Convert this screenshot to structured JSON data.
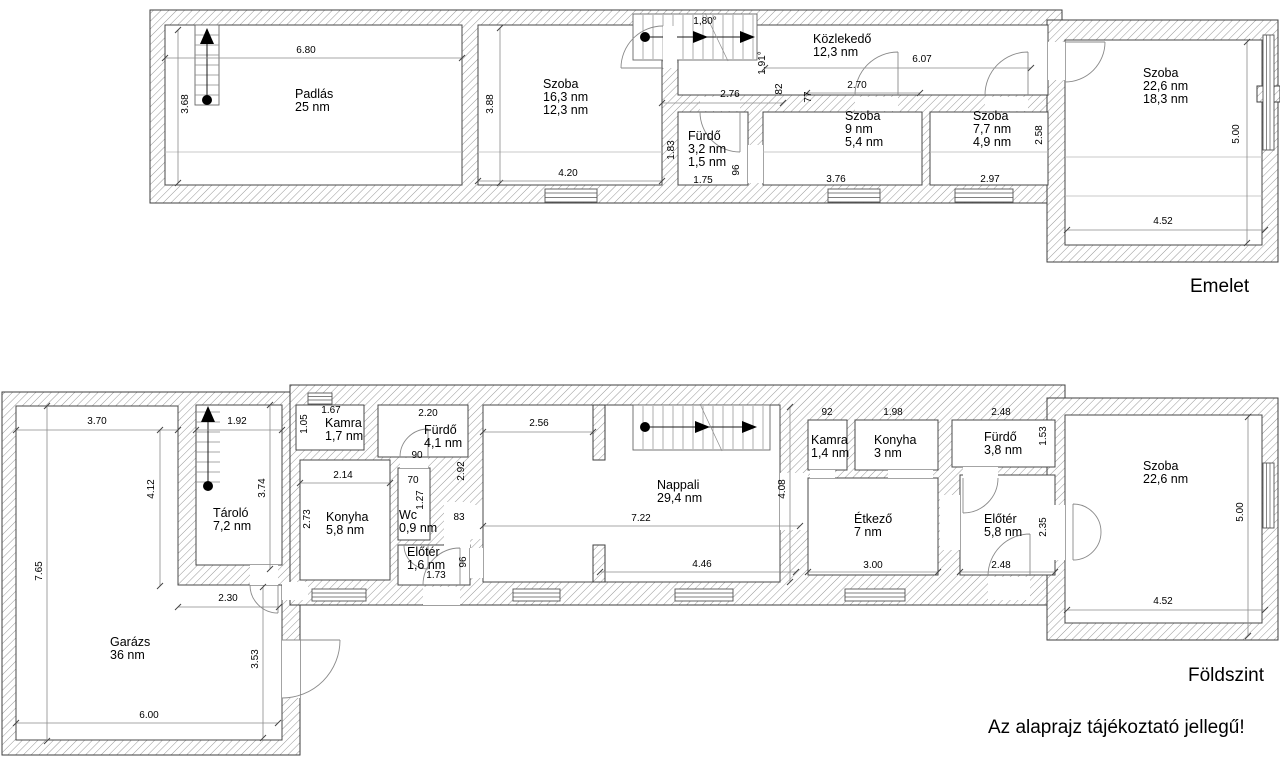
{
  "note": "Az alaprajz tájékoztató jellegű!",
  "floors": [
    {
      "id": "emelet",
      "label": "Emelet",
      "rooms": [
        {
          "name": "Padlás",
          "areas": [
            "25 nm"
          ],
          "x": 295,
          "y": 88
        },
        {
          "name": "Szoba",
          "areas": [
            "16,3 nm",
            "12,3 nm"
          ],
          "x": 543,
          "y": 78
        },
        {
          "name": "Fürdő",
          "areas": [
            "3,2 nm",
            "1,5 nm"
          ],
          "x": 688,
          "y": 130
        },
        {
          "name": "Közlekedő",
          "areas": [
            "12,3 nm"
          ],
          "x": 813,
          "y": 33
        },
        {
          "name": "Szoba",
          "areas": [
            "9 nm",
            "5,4 nm"
          ],
          "x": 845,
          "y": 110
        },
        {
          "name": "Szoba",
          "areas": [
            "7,7 nm",
            "4,9 nm"
          ],
          "x": 973,
          "y": 110
        },
        {
          "name": "Szoba",
          "areas": [
            "22,6 nm",
            "18,3 nm"
          ],
          "x": 1143,
          "y": 67
        }
      ],
      "dims": [
        {
          "t": "6.80",
          "x": 306,
          "y": 51,
          "line": [
            165,
            58,
            462,
            58
          ]
        },
        {
          "t": "3.68",
          "x": 186,
          "y": 104,
          "r": 1,
          "line": [
            178,
            30,
            178,
            183
          ]
        },
        {
          "t": "3.88",
          "x": 491,
          "y": 104,
          "r": 1,
          "line": [
            500,
            28,
            500,
            183
          ]
        },
        {
          "t": "4.20",
          "x": 568,
          "y": 174,
          "line": [
            478,
            181,
            662,
            181
          ]
        },
        {
          "t": "1.83",
          "x": 672,
          "y": 150,
          "r": 1
        },
        {
          "t": "1.75",
          "x": 703,
          "y": 181
        },
        {
          "t": "96",
          "x": 737,
          "y": 170,
          "r": 1
        },
        {
          "t": "2.76",
          "x": 730,
          "y": 95,
          "line": [
            662,
            103,
            783,
            103
          ]
        },
        {
          "t": "1,80°",
          "x": 705,
          "y": 22
        },
        {
          "t": "1.91°",
          "x": 763,
          "y": 63,
          "r": 1
        },
        {
          "t": "82",
          "x": 780,
          "y": 89,
          "r": 1
        },
        {
          "t": "77",
          "x": 809,
          "y": 97,
          "r": 1
        },
        {
          "t": "2.70",
          "x": 857,
          "y": 86,
          "line": [
            807,
            93,
            920,
            93
          ]
        },
        {
          "t": "6.07",
          "x": 922,
          "y": 60,
          "line": [
            765,
            68,
            1031,
            68
          ]
        },
        {
          "t": "3.76",
          "x": 836,
          "y": 180
        },
        {
          "t": "2.97",
          "x": 990,
          "y": 180
        },
        {
          "t": "2.58",
          "x": 1040,
          "y": 135,
          "r": 1
        },
        {
          "t": "5.00",
          "x": 1237,
          "y": 134,
          "r": 1,
          "line": [
            1247,
            42,
            1247,
            243
          ]
        },
        {
          "t": "4.52",
          "x": 1163,
          "y": 222,
          "line": [
            1067,
            230,
            1265,
            230
          ]
        }
      ]
    },
    {
      "id": "foldszint",
      "label": "Földszint",
      "rooms": [
        {
          "name": "Garázs",
          "areas": [
            "36 nm"
          ],
          "x": 110,
          "y": 636
        },
        {
          "name": "Tároló",
          "areas": [
            "7,2 nm"
          ],
          "x": 213,
          "y": 507
        },
        {
          "name": "Kamra",
          "areas": [
            "1,7 nm"
          ],
          "x": 325,
          "y": 417
        },
        {
          "name": "Fürdő",
          "areas": [
            "4,1 nm"
          ],
          "x": 424,
          "y": 424
        },
        {
          "name": "Konyha",
          "areas": [
            "5,8 nm"
          ],
          "x": 326,
          "y": 511
        },
        {
          "name": "Wc",
          "areas": [
            "0,9 nm"
          ],
          "x": 399,
          "y": 509
        },
        {
          "name": "Előtér",
          "areas": [
            "1,6 nm"
          ],
          "x": 407,
          "y": 546
        },
        {
          "name": "Nappali",
          "areas": [
            "29,4 nm"
          ],
          "x": 657,
          "y": 479
        },
        {
          "name": "Kamra",
          "areas": [
            "1,4 nm"
          ],
          "x": 811,
          "y": 434
        },
        {
          "name": "Konyha",
          "areas": [
            "3 nm"
          ],
          "x": 874,
          "y": 434
        },
        {
          "name": "Fürdő",
          "areas": [
            "3,8 nm"
          ],
          "x": 984,
          "y": 431
        },
        {
          "name": "Étkező",
          "areas": [
            "7 nm"
          ],
          "x": 854,
          "y": 513
        },
        {
          "name": "Előtér",
          "areas": [
            "5,8 nm"
          ],
          "x": 984,
          "y": 513
        },
        {
          "name": "Szoba",
          "areas": [
            "22,6 nm"
          ],
          "x": 1143,
          "y": 460
        }
      ],
      "dims": [
        {
          "t": "3.70",
          "x": 97,
          "y": 422,
          "line": [
            16,
            430,
            178,
            430
          ]
        },
        {
          "t": "1.92",
          "x": 237,
          "y": 422,
          "line": [
            196,
            430,
            282,
            430
          ]
        },
        {
          "t": "1.05",
          "x": 305,
          "y": 424,
          "r": 1
        },
        {
          "t": "1.67",
          "x": 331,
          "y": 411
        },
        {
          "t": "2.20",
          "x": 428,
          "y": 414
        },
        {
          "t": "2.56",
          "x": 539,
          "y": 424,
          "line": [
            483,
            432,
            593,
            432
          ]
        },
        {
          "t": "92",
          "x": 827,
          "y": 413
        },
        {
          "t": "1.98",
          "x": 893,
          "y": 413
        },
        {
          "t": "2.48",
          "x": 1001,
          "y": 413
        },
        {
          "t": "1.53",
          "x": 1044,
          "y": 436,
          "r": 1
        },
        {
          "t": "4.12",
          "x": 152,
          "y": 489,
          "r": 1,
          "line": [
            160,
            430,
            160,
            586
          ]
        },
        {
          "t": "3.74",
          "x": 263,
          "y": 488,
          "r": 1,
          "line": [
            270,
            405,
            270,
            569
          ]
        },
        {
          "t": "2.73",
          "x": 308,
          "y": 519,
          "r": 1
        },
        {
          "t": "2.14",
          "x": 343,
          "y": 476,
          "line": [
            300,
            483,
            390,
            483
          ]
        },
        {
          "t": "90",
          "x": 417,
          "y": 456
        },
        {
          "t": "70",
          "x": 413,
          "y": 481
        },
        {
          "t": "1.27",
          "x": 421,
          "y": 500,
          "r": 1
        },
        {
          "t": "2.92",
          "x": 462,
          "y": 471,
          "r": 1
        },
        {
          "t": "83",
          "x": 459,
          "y": 518
        },
        {
          "t": "96",
          "x": 464,
          "y": 562,
          "r": 1
        },
        {
          "t": "1.73",
          "x": 436,
          "y": 576
        },
        {
          "t": "7.22",
          "x": 641,
          "y": 519,
          "line": [
            483,
            526,
            800,
            526
          ]
        },
        {
          "t": "4.08",
          "x": 783,
          "y": 489,
          "r": 1,
          "line": [
            790,
            407,
            790,
            582
          ]
        },
        {
          "t": "4.46",
          "x": 702,
          "y": 565,
          "line": [
            600,
            572,
            796,
            572
          ]
        },
        {
          "t": "7.65",
          "x": 40,
          "y": 571,
          "r": 1,
          "line": [
            47,
            406,
            47,
            741
          ]
        },
        {
          "t": "2.30",
          "x": 228,
          "y": 599,
          "line": [
            178,
            607,
            279,
            607
          ]
        },
        {
          "t": "3.53",
          "x": 256,
          "y": 659,
          "r": 1,
          "line": [
            263,
            587,
            263,
            738
          ]
        },
        {
          "t": "6.00",
          "x": 149,
          "y": 716,
          "line": [
            16,
            723,
            278,
            723
          ]
        },
        {
          "t": "3.00",
          "x": 873,
          "y": 566,
          "line": [
            808,
            572,
            938,
            572
          ]
        },
        {
          "t": "2.48",
          "x": 1001,
          "y": 566,
          "line": [
            960,
            572,
            1055,
            572
          ]
        },
        {
          "t": "2.35",
          "x": 1044,
          "y": 527,
          "r": 1
        },
        {
          "t": "5.00",
          "x": 1241,
          "y": 512,
          "r": 1,
          "line": [
            1248,
            417,
            1248,
            636
          ]
        },
        {
          "t": "4.52",
          "x": 1163,
          "y": 602,
          "line": [
            1067,
            610,
            1265,
            610
          ]
        }
      ]
    }
  ]
}
